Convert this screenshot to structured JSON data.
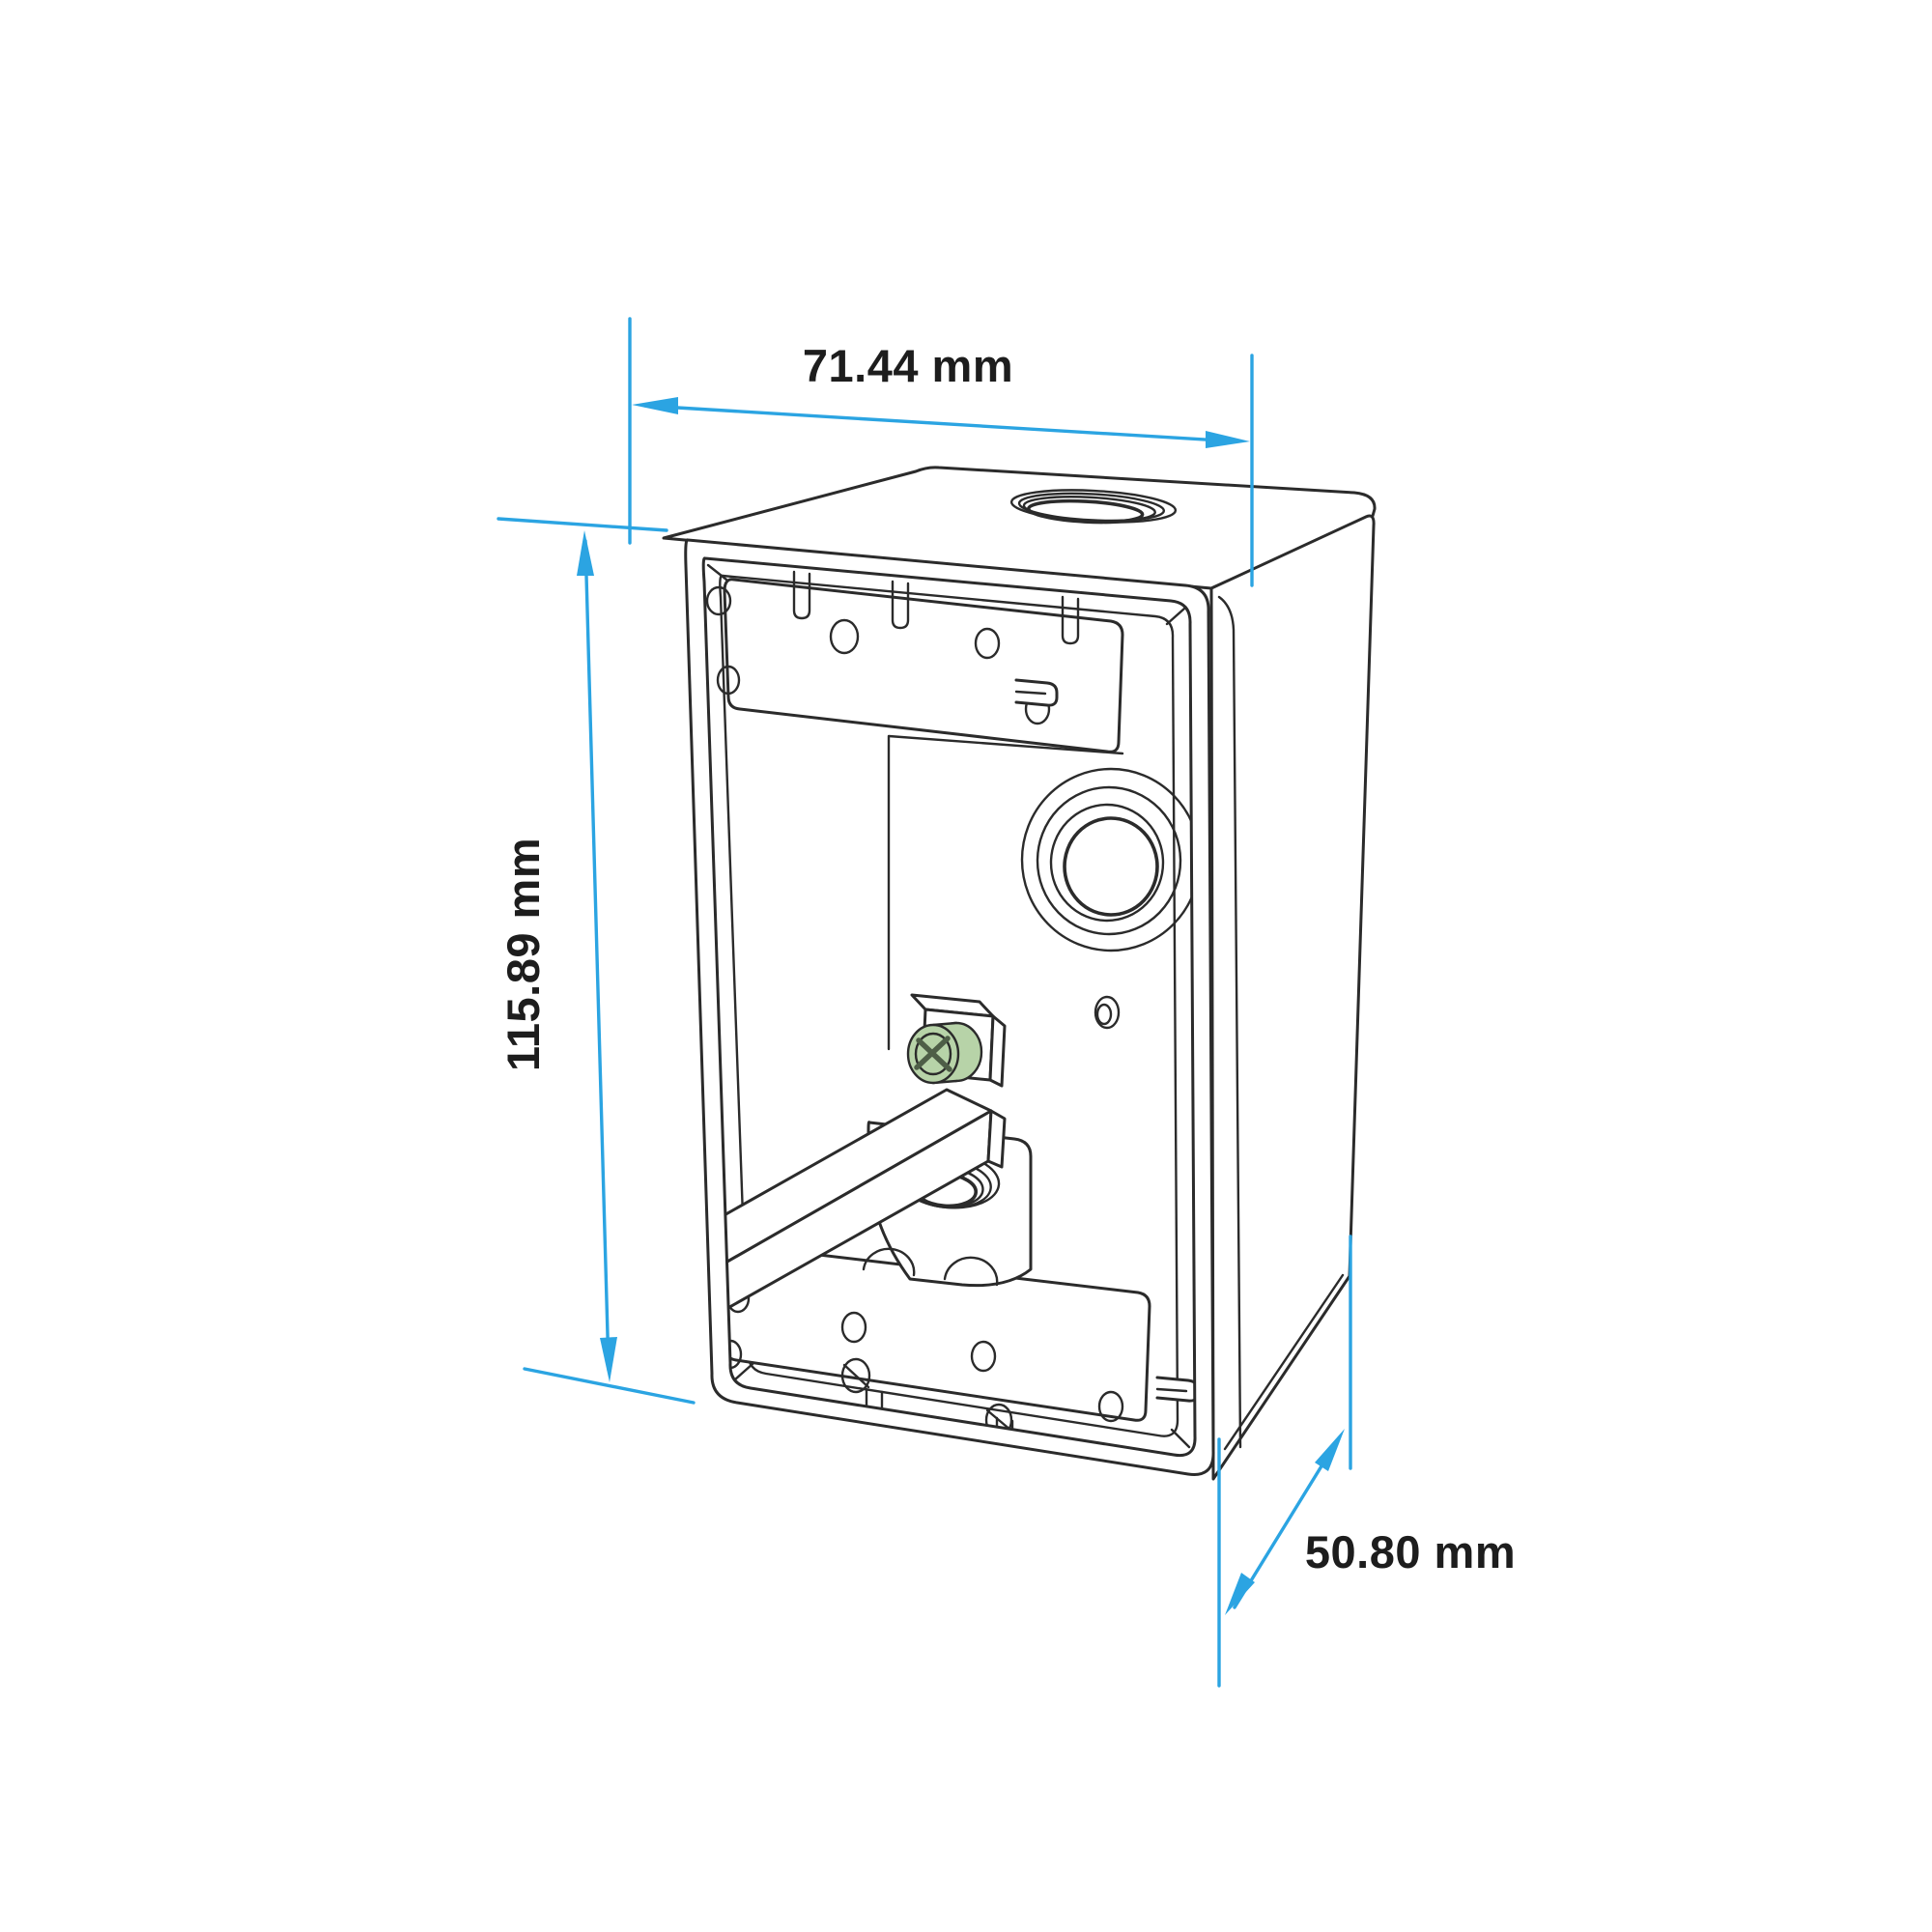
{
  "drawing": {
    "kind": "dimensioned isometric technical line drawing",
    "subject": "single-gang weatherproof electrical outlet box, open front, three threaded conduit hubs"
  },
  "colors": {
    "background": "#ffffff",
    "line": "#2b2b2b",
    "dimension": "#2ba4e2",
    "screw_head": "#b7d3a8",
    "screw_detail": "#4e5e47",
    "text": "#1d1d1d"
  },
  "dimensions": {
    "width": {
      "label": "71.44 mm"
    },
    "height": {
      "label": "115.89 mm"
    },
    "depth": {
      "label": "50.80 mm"
    }
  },
  "parts": {
    "top_hub": "threaded-hub-top",
    "back_hub": "threaded-hub-back",
    "bottom_hub": "threaded-hub-bottom",
    "ground_screw": "green-grounding-screw",
    "plates": "drilled-mounting-plates",
    "rail": "mounting-rail"
  }
}
